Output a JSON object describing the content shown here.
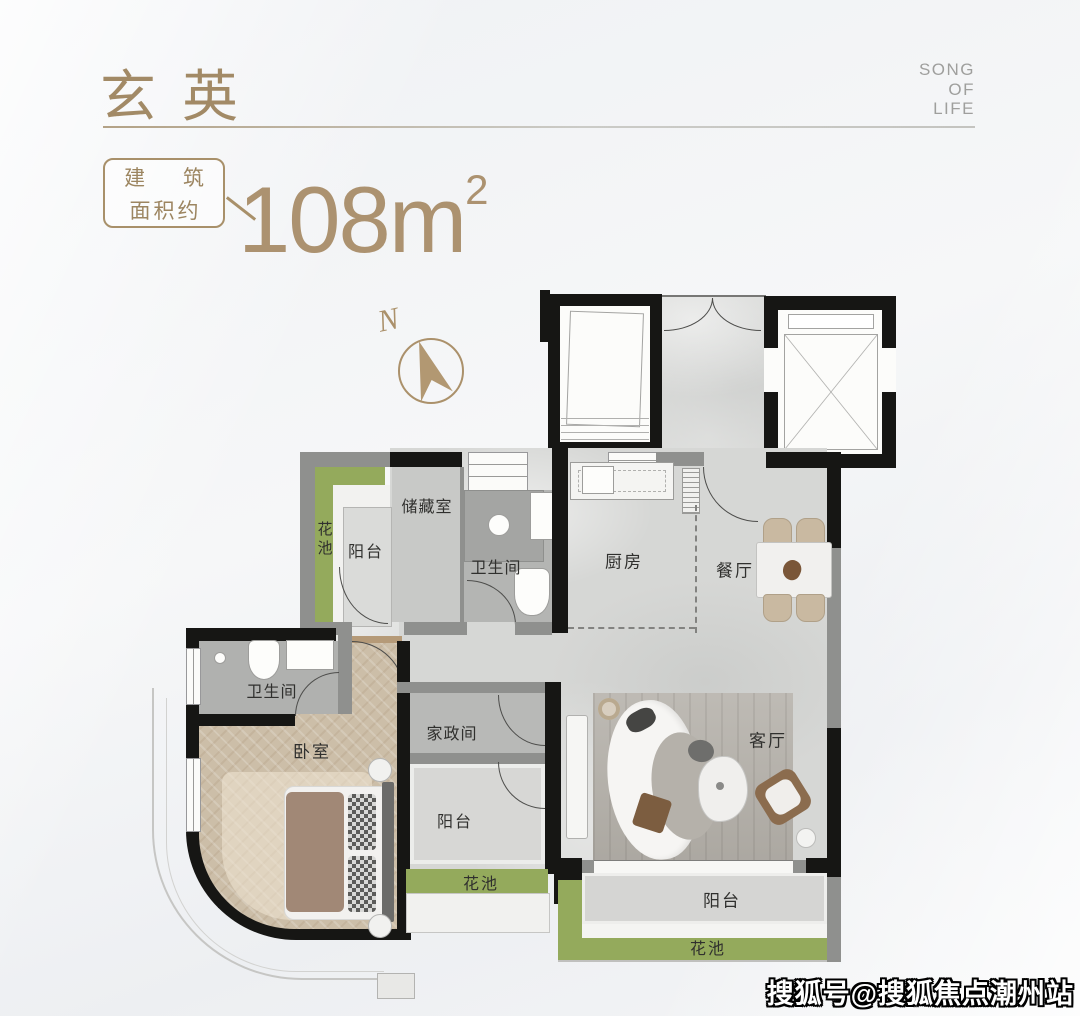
{
  "header": {
    "title": "玄英",
    "slogan": [
      "SONG",
      "OF",
      "LIFE"
    ],
    "area_label": [
      "建 筑",
      "面积约"
    ],
    "area_value": "108m",
    "area_unit_sup": "2"
  },
  "compass": {
    "north": "N"
  },
  "plan": {
    "labels": {
      "flower_bed_tl": "花池",
      "balcony_tl": "阳台",
      "storage": "储藏室",
      "bath_main": "卫生间",
      "kitchen": "厨房",
      "dining": "餐厅",
      "bath_master": "卫生间",
      "bedroom": "卧室",
      "housekeeping": "家政间",
      "living": "客厅",
      "balcony_mid": "阳台",
      "flower_bed_mid": "花池",
      "balcony_bottom": "阳台",
      "flower_bed_bottom": "花池"
    },
    "colors": {
      "accent_gold": "#a8906a",
      "flower_bed_green": "#94aa5c",
      "wall_black": "#161614",
      "wall_gray": "#8f908e"
    }
  },
  "watermark": {
    "text": "搜狐号@搜狐焦点潮州站"
  }
}
